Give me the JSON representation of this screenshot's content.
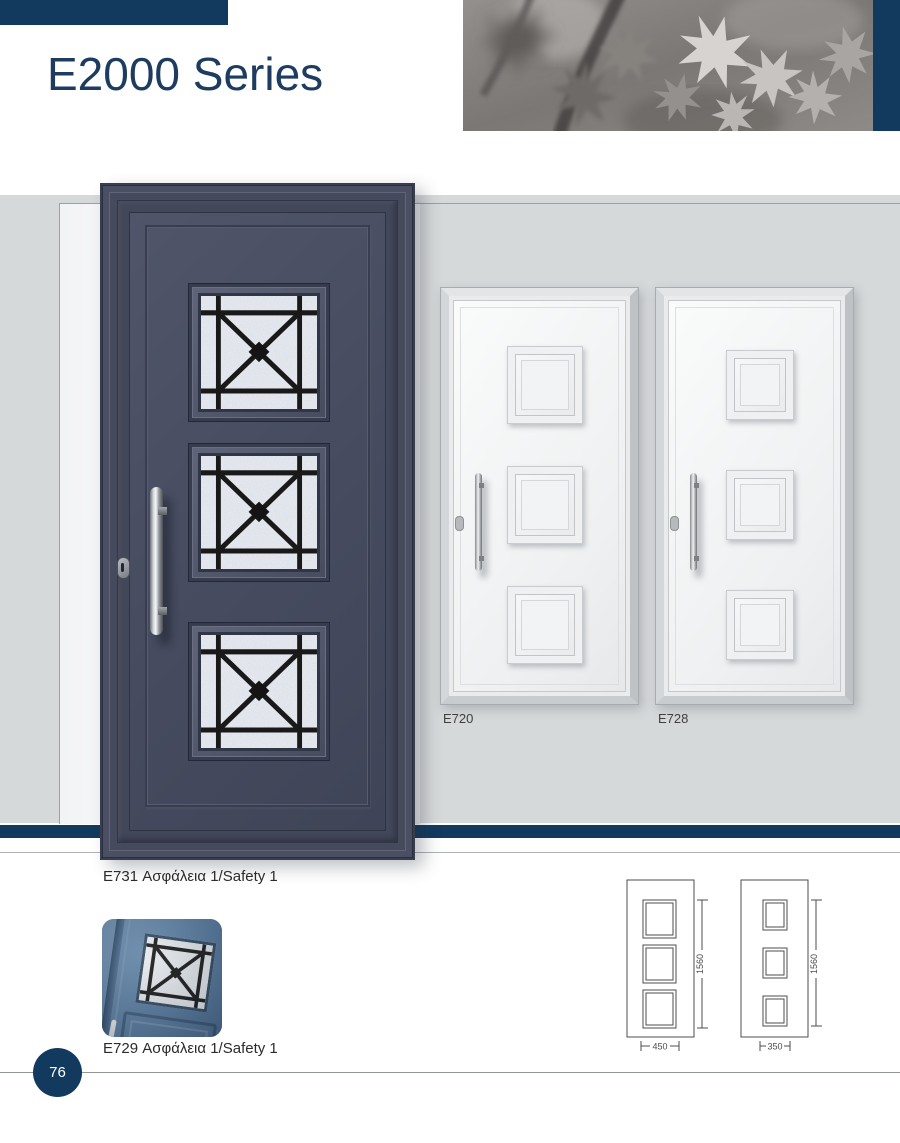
{
  "header": {
    "title": "E2000 Series"
  },
  "catalog": {
    "caption_e731": "E731 Ασφάλεια 1/Safety 1",
    "caption_e729": "E729 Ασφάλεια 1/Safety 1",
    "label_e720": "E720",
    "label_e728": "E728"
  },
  "drawings": {
    "left": {
      "height": "1560",
      "width": "450"
    },
    "right": {
      "height": "1560",
      "width": "350"
    }
  },
  "footer": {
    "page_number": "76"
  },
  "colors": {
    "navy": "#123a5e",
    "door_navy": "#4a4f63",
    "band_gray": "#d6d9da",
    "thumb_blue": "#5a7da1",
    "title_navy": "#1d3c60"
  }
}
